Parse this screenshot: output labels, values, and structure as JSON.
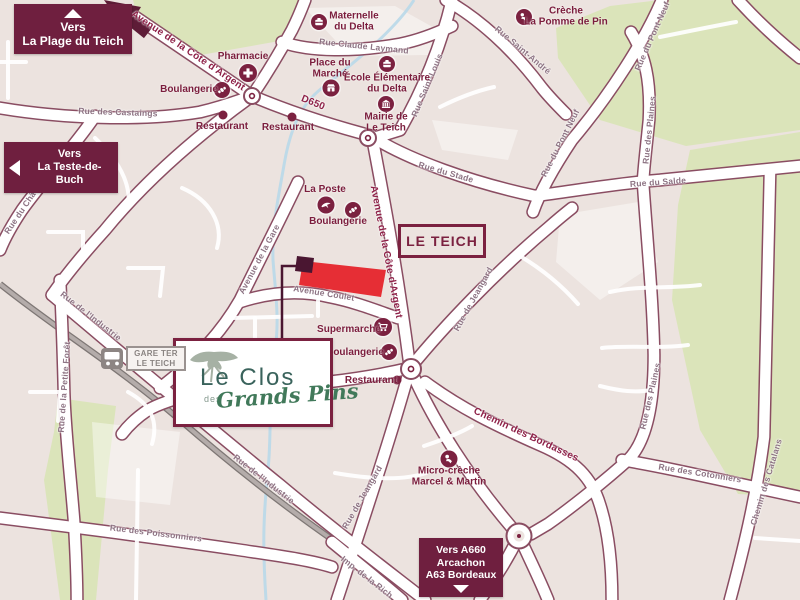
{
  "map": {
    "region_label": "LE TEICH",
    "badges": {
      "plage": {
        "lines": [
          "Vers",
          "La Plage du Teich"
        ],
        "arrow": "up"
      },
      "teste": {
        "lines": [
          "Vers",
          "La Teste-de-Buch"
        ],
        "arrow": "left"
      },
      "a660": {
        "lines": [
          "Vers A660",
          "Arcachon",
          "A63 Bordeaux"
        ],
        "arrow": "down"
      }
    },
    "logo": {
      "title": "Le Clos",
      "middle": "des",
      "subtitle": "Grands Pins"
    },
    "station": {
      "lines": [
        "GARE TER",
        "LE TEICH"
      ],
      "icon": "train"
    },
    "colors": {
      "badge": "#6f1f3f",
      "poi": "#7b2140",
      "road_casing": "#8a4d62",
      "green": "#dbe4ba",
      "background": "#ece3df",
      "parcel": "#e62e35",
      "water": "#b9d8e9",
      "railway": "#b4acaa",
      "street_label": "#8d7383",
      "street_label_major": "#8e2148",
      "logo_title": "#3a635c",
      "logo_script": "#41795a"
    },
    "streets": [
      {
        "name": "Avenue de la Côte d'Argent",
        "x": 188,
        "y": 51,
        "rot": 34,
        "cls": "major"
      },
      {
        "name": "D650",
        "x": 313,
        "y": 103,
        "rot": 22,
        "cls": "major"
      },
      {
        "name": "Rue des Castaings",
        "x": 118,
        "y": 112,
        "rot": 2,
        "cls": "minor"
      },
      {
        "name": "Rue Claude Laymand",
        "x": 364,
        "y": 46,
        "rot": 6,
        "cls": "minor"
      },
      {
        "name": "Rue Saint-André",
        "x": 523,
        "y": 50,
        "rot": 40,
        "cls": "minor"
      },
      {
        "name": "Rue Saint-Louis",
        "x": 427,
        "y": 85,
        "rot": -67,
        "cls": "minor"
      },
      {
        "name": "Rue du Pont Neuf",
        "x": 652,
        "y": 36,
        "rot": -66,
        "cls": "minor"
      },
      {
        "name": "Rue du Pont Neuf",
        "x": 560,
        "y": 143,
        "rot": -63,
        "cls": "minor"
      },
      {
        "name": "Rue du Stade",
        "x": 446,
        "y": 172,
        "rot": 16,
        "cls": "minor"
      },
      {
        "name": "Rue du Salde",
        "x": 658,
        "y": 182,
        "rot": -4,
        "cls": "minor"
      },
      {
        "name": "Rue des Plaines",
        "x": 649,
        "y": 130,
        "rot": -84,
        "cls": "minor"
      },
      {
        "name": "Rue des Plaines",
        "x": 650,
        "y": 396,
        "rot": -77,
        "cls": "minor"
      },
      {
        "name": "Rue du Château",
        "x": 25,
        "y": 205,
        "rot": -56,
        "cls": "minor"
      },
      {
        "name": "Avenue de la Gare",
        "x": 259,
        "y": 259,
        "rot": -62,
        "cls": "minor"
      },
      {
        "name": "Avenue Coulet",
        "x": 324,
        "y": 293,
        "rot": 9,
        "cls": "minor"
      },
      {
        "name": "Avenue de la Côte d'Argent",
        "x": 386,
        "y": 252,
        "rot": 79,
        "cls": "major"
      },
      {
        "name": "Rue de Jeangard",
        "x": 473,
        "y": 299,
        "rot": -61,
        "cls": "minor"
      },
      {
        "name": "Rue de Jeangard",
        "x": 362,
        "y": 497,
        "rot": -60,
        "cls": "minor"
      },
      {
        "name": "Chemin des Bordasses",
        "x": 526,
        "y": 435,
        "rot": 25,
        "cls": "major"
      },
      {
        "name": "Rue des Cotonniers",
        "x": 700,
        "y": 473,
        "rot": 9,
        "cls": "minor"
      },
      {
        "name": "Chemin des Catalans",
        "x": 766,
        "y": 482,
        "rot": -73,
        "cls": "minor"
      },
      {
        "name": "Rue des Poissonniers",
        "x": 156,
        "y": 533,
        "rot": 7,
        "cls": "minor"
      },
      {
        "name": "Rue de l'Industrie",
        "x": 91,
        "y": 316,
        "rot": 38,
        "cls": "minor"
      },
      {
        "name": "Rue de l'Industrie",
        "x": 264,
        "y": 479,
        "rot": 38,
        "cls": "minor"
      },
      {
        "name": "Rue de la Petite Forêt",
        "x": 64,
        "y": 387,
        "rot": -86,
        "cls": "minor"
      },
      {
        "name": "Imp. de la Rich",
        "x": 367,
        "y": 577,
        "rot": 38,
        "cls": "minor"
      }
    ],
    "pois": [
      {
        "id": "pharmacie",
        "icon": "pharmacy",
        "ix": 248,
        "iy": 73,
        "size": 18,
        "lines": [
          "Pharmacie"
        ],
        "lx": 243,
        "ly": 57
      },
      {
        "id": "boulangerie-nord",
        "icon": "bakery",
        "ix": 222,
        "iy": 90,
        "size": 16,
        "lines": [
          "Boulangerie"
        ],
        "lx": 189,
        "ly": 90
      },
      {
        "id": "restaurant-ouest",
        "icon": "dot",
        "ix": 223,
        "iy": 115,
        "size": 9,
        "lines": [
          "Restaurant"
        ],
        "lx": 222,
        "ly": 127
      },
      {
        "id": "restaurant-est",
        "icon": "dot",
        "ix": 292,
        "iy": 117,
        "size": 9,
        "lines": [
          "Restaurant"
        ],
        "lx": 288,
        "ly": 128
      },
      {
        "id": "maternelle-delta",
        "icon": "school",
        "ix": 319,
        "iy": 22,
        "size": 16,
        "lines": [
          "Maternelle",
          "du Delta"
        ],
        "lx": 354,
        "ly": 22
      },
      {
        "id": "place-du-marche",
        "icon": "market",
        "ix": 331,
        "iy": 88,
        "size": 17,
        "lines": [
          "Place du",
          "Marché"
        ],
        "lx": 330,
        "ly": 69
      },
      {
        "id": "ecole-delta",
        "icon": "school",
        "ix": 387,
        "iy": 64,
        "size": 16,
        "lines": [
          "École Élémentaire",
          "du Delta"
        ],
        "lx": 387,
        "ly": 84
      },
      {
        "id": "mairie",
        "icon": "hall",
        "ix": 386,
        "iy": 104,
        "size": 16,
        "lines": [
          "Mairie de",
          "Le Teich"
        ],
        "lx": 386,
        "ly": 123
      },
      {
        "id": "creche-pomme-de-pin",
        "icon": "baby",
        "ix": 524,
        "iy": 17,
        "size": 16,
        "lines": [
          "Crèche",
          "La Pomme de Pin"
        ],
        "lx": 566,
        "ly": 17
      },
      {
        "id": "la-poste",
        "icon": "bird",
        "ix": 326,
        "iy": 205,
        "size": 17,
        "lines": [
          "La Poste"
        ],
        "lx": 325,
        "ly": 190
      },
      {
        "id": "boulangerie-centre",
        "icon": "bakery",
        "ix": 353,
        "iy": 210,
        "size": 16,
        "lines": [
          "Boulangerie"
        ],
        "lx": 338,
        "ly": 222
      },
      {
        "id": "supermarche",
        "icon": "cart",
        "ix": 383,
        "iy": 327,
        "size": 18,
        "lines": [
          "Supermarché"
        ],
        "lx": 349,
        "ly": 330
      },
      {
        "id": "boulangerie-sud",
        "icon": "bakery",
        "ix": 389,
        "iy": 352,
        "size": 16,
        "lines": [
          "Boulangerie"
        ],
        "lx": 355,
        "ly": 353
      },
      {
        "id": "restaurant-sud",
        "icon": "dot",
        "ix": 397,
        "iy": 380,
        "size": 9,
        "lines": [
          "Restaurant"
        ],
        "lx": 371,
        "ly": 381
      },
      {
        "id": "micro-creche",
        "icon": "baby",
        "ix": 449,
        "iy": 459,
        "size": 17,
        "lines": [
          "Micro-crèche",
          "Marcel & Martin"
        ],
        "lx": 449,
        "ly": 477
      }
    ]
  }
}
